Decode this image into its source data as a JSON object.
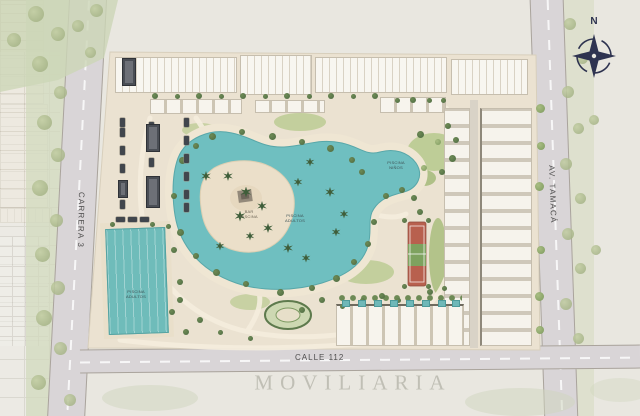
{
  "streets": {
    "left": "CARRERA 3",
    "bottom": "CALLE 112",
    "right": "AV. TAMACÁ"
  },
  "compass": {
    "north": "N"
  },
  "watermark": {
    "text": "MOVILIARIA"
  },
  "labels": {
    "pool_bar": "BAR\nPISCINA",
    "main_pool": "PISCINA\nADULTOS",
    "kids_pool": "PISCINA\nNIÑOS",
    "lap_pool": "PISCINA\nADULTOS"
  },
  "colors": {
    "water": "#6fbfc0",
    "sand": "#ebe2d1",
    "deck": "#efe6d3",
    "vegetation": "#6d8a55",
    "court_red": "#b8604e",
    "court_green": "#7ea25f",
    "road": "#d9d5d7",
    "compass_navy": "#2e3350",
    "watermark_grey": "#8a887a"
  }
}
